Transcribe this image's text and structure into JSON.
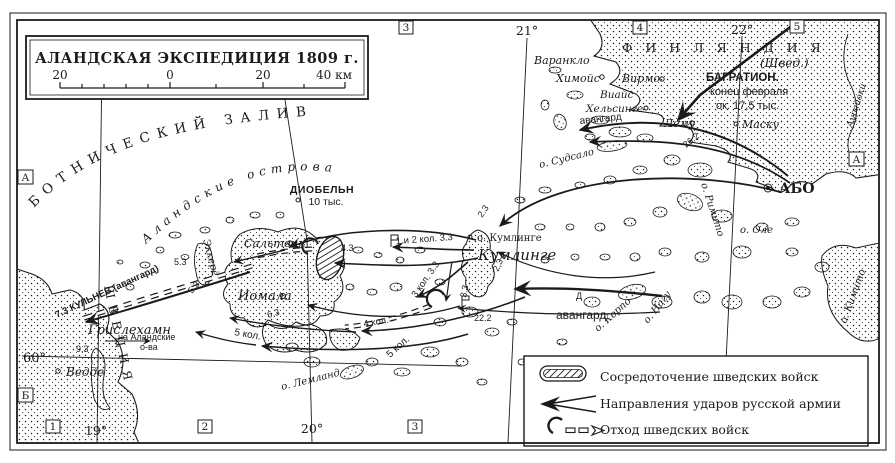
{
  "title_box": {
    "title": "АЛАНДСКАЯ ЭКСПЕДИЦИЯ 1809 г.",
    "scale_labels": [
      "20",
      "0",
      "20",
      "40 км"
    ]
  },
  "grid": {
    "top_b3": "3",
    "top_lon21": "21°",
    "top_b4": "4",
    "top_lon22": "22°",
    "top_b5": "5",
    "bot_b1": "1",
    "bot_lon19": "19°",
    "bot_b2": "2",
    "bot_lon20": "20°",
    "bot_b3": "3",
    "left_bA": "А",
    "left_bB": "Б",
    "right_bA": "А",
    "lat60": "60°"
  },
  "regions": {
    "gulf": "БОТНИЧЕСКИЙ ЗАЛИВ",
    "aland": "Аландские острова",
    "sweden": "ШВЕЦИЯ",
    "finland": "ФИНЛЯНДИЯ",
    "finland_note": "(Швед.)"
  },
  "places": {
    "varanklo": "Варанкло",
    "himois": "Химойс",
    "virmo": "Вирмо",
    "viais": "Виайс",
    "helsinge": "Хельсинге",
    "lemu": "Лему",
    "masku": "Маску",
    "abo": "АБО",
    "aurajoki": "Аурайоки",
    "sudsalo": "о. Судсало",
    "rimito": "о. Римито",
    "ole": "о. Оле",
    "nagu": "о. Нагу",
    "korpo": "о. Корпо",
    "kimito": "о. Кимито",
    "kumlinge_isl": "о. Кумлинге",
    "kumlinge_town": "Кумлинге",
    "saltvik": "Сальтвик",
    "jomala": "Иомала",
    "eckero": "Эккерё",
    "lemland": "о. Лемланд",
    "grislehamn": "Грислехамн",
    "vedde": "Ведде"
  },
  "annotations": {
    "bagration_1": "БАГРАТИОН.",
    "bagration_2": "конец февраля",
    "bagration_3": "ок. 17,5 тыс.",
    "dobeln_1": "ДИОБЕЛЬН",
    "dobeln_2": "10 тыс.",
    "kulnev": "7.3 КУЛЬНЕВ (авангард)",
    "to_aland_1": "на Аландские",
    "to_aland_2": "о-ва",
    "vanguard_north": "авангард",
    "vanguard_east": "авангард",
    "col_1_2": "1 и 2 кол. 3.3",
    "col_3": "3 кол. 3.3",
    "col_4": "4 кол.",
    "col_5_south": "5 кол.",
    "col_5_west": "5 кол.",
    "d_mark": "Д"
  },
  "dates": {
    "d22_2": "22.2",
    "d26_2": "26.2",
    "d2_3a": "2.3",
    "d2_3b": "2,3",
    "d3_3": "3.3",
    "d4_3": "4.3",
    "d5_3a": "5.3",
    "d5_3b": "5.3",
    "d6_3": "6.3",
    "d9_3": "9.3"
  },
  "legend": {
    "item1": "Сосредоточение шведских войск",
    "item2": "Направления ударов русской армии",
    "item3": "Отход шведских войск"
  },
  "colors": {
    "ink": "#1b1b1b",
    "paper": "#ffffff"
  }
}
